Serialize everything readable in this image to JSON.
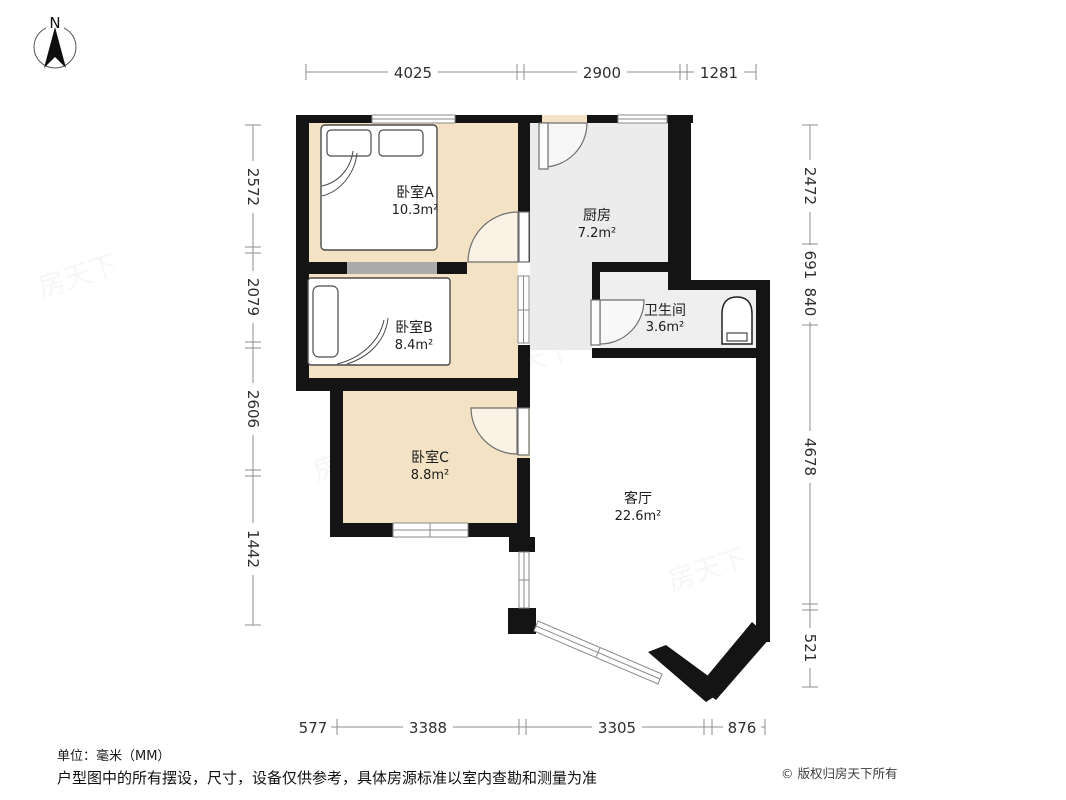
{
  "compass": {
    "label": "N"
  },
  "rooms": [
    {
      "name": "卧室A",
      "area": "10.3m²"
    },
    {
      "name": "卧室B",
      "area": "8.4m²"
    },
    {
      "name": "卧室C",
      "area": "8.8m²"
    },
    {
      "name": "厨房",
      "area": "7.2m²"
    },
    {
      "name": "卫生间",
      "area": "3.6m²"
    },
    {
      "name": "客厅",
      "area": "22.6m²"
    }
  ],
  "dimensions": {
    "top": [
      "4025",
      "2900",
      "1281"
    ],
    "left": [
      "2572",
      "2079",
      "2606",
      "1442"
    ],
    "right": [
      "2472",
      "691",
      "840",
      "4678",
      "521"
    ],
    "bottom": [
      "577",
      "3388",
      "3305",
      "876"
    ]
  },
  "footer": {
    "unit_note": "单位：毫米（MM）",
    "disclaimer": "户型图中的所有摆设，尺寸，设备仅供参考，具体房源标准以室内查勘和测量为准",
    "copyright": "© 版权归房天下所有"
  },
  "watermark": "房天下",
  "colors": {
    "room_tan": "#f3e3c4",
    "kitchen_gray": "#ececec",
    "bath_gray": "#efefef",
    "wall": "#141414",
    "light_wall": "#ababab",
    "dim_line": "#8c8c8c",
    "window_line": "#8a8a8a"
  }
}
